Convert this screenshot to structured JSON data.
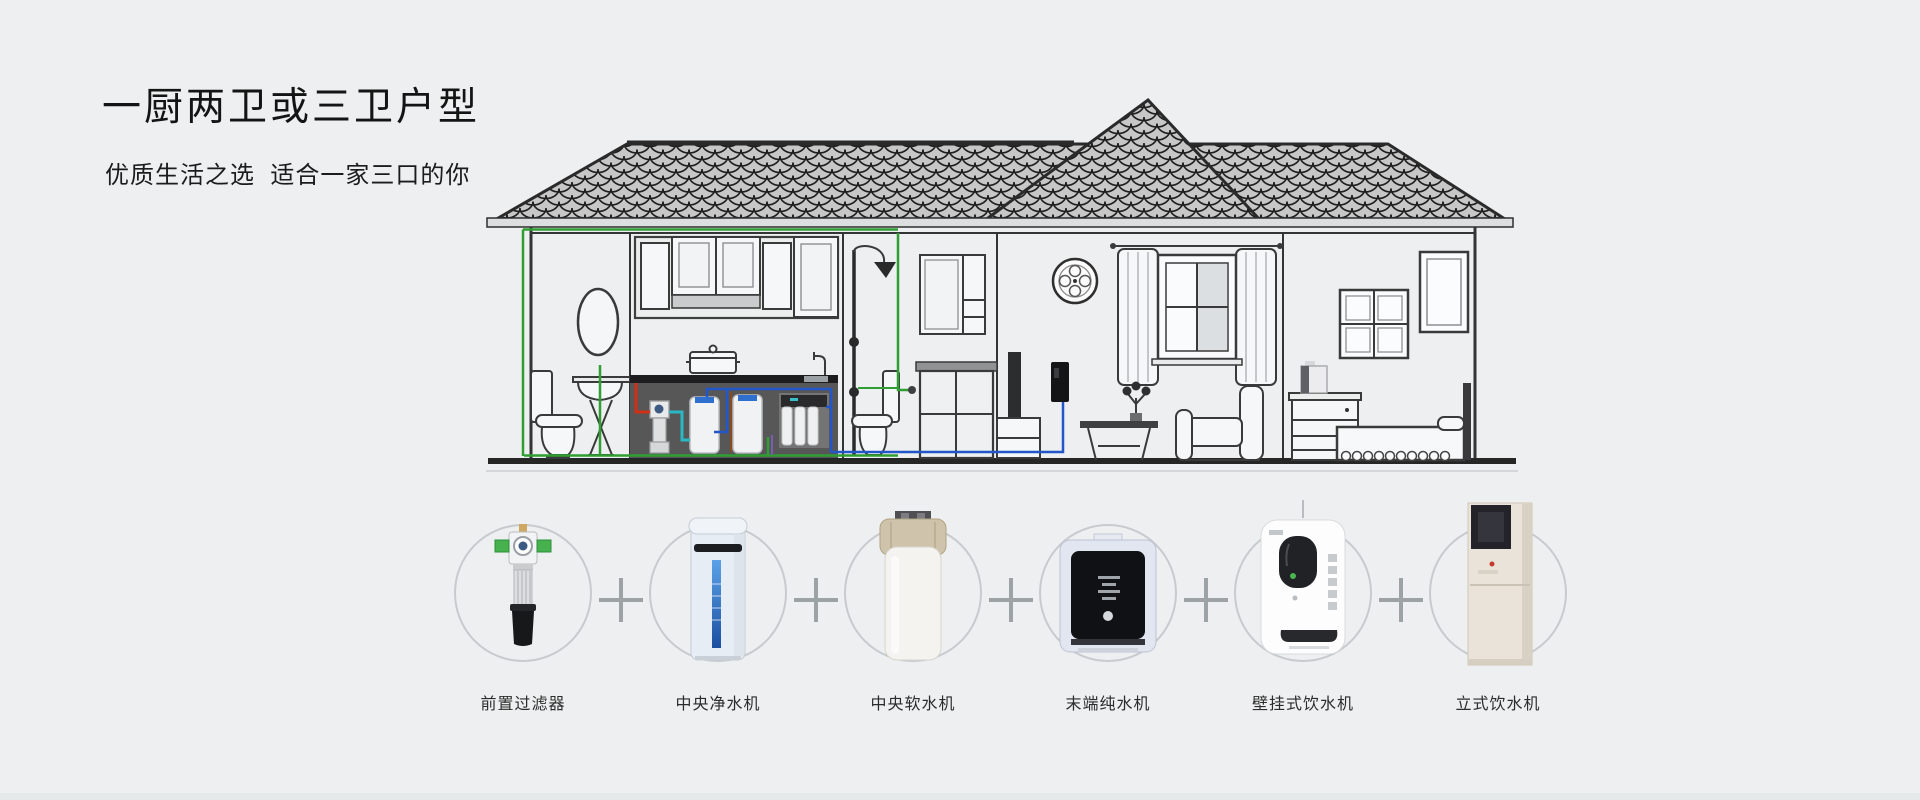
{
  "header": {
    "title": "一厨两卫或三卫户型",
    "subtitle": "优质生活之选  适合一家三口的你"
  },
  "house_diagram": {
    "description_icons": [
      "roof-tiles-icon",
      "bathroom-icon",
      "kitchen-icon",
      "shower-room-icon",
      "living-room-icon",
      "bedroom-icon"
    ],
    "pipe_colors": {
      "cold_water_green": "#2f9e33",
      "purified_blue": "#2257c9",
      "raw_red": "#d03015",
      "softened_cyan": "#2ab9c4",
      "hot_brown": "#8a4a22"
    },
    "line_color": "#3a3a3a",
    "roof_tile_color": "#c7c7c7",
    "counter_color": "#575757"
  },
  "products": {
    "separator_icon": "plus-icon",
    "circle_ring_color": "#c7cbce",
    "items": [
      {
        "label": "前置过滤器",
        "icon": "pre-filter-icon"
      },
      {
        "label": "中央净水机",
        "icon": "central-water-purifier-icon"
      },
      {
        "label": "中央软水机",
        "icon": "central-water-softener-icon"
      },
      {
        "label": "末端纯水机",
        "icon": "terminal-pure-water-machine-icon"
      },
      {
        "label": "壁挂式饮水机",
        "icon": "wall-mounted-water-dispenser-icon"
      },
      {
        "label": "立式饮水机",
        "icon": "standing-water-dispenser-icon"
      }
    ]
  },
  "colors": {
    "background": "#edeff0",
    "title_text": "#141414",
    "label_text": "#2c2c2c",
    "plus": "#9da2a5"
  }
}
